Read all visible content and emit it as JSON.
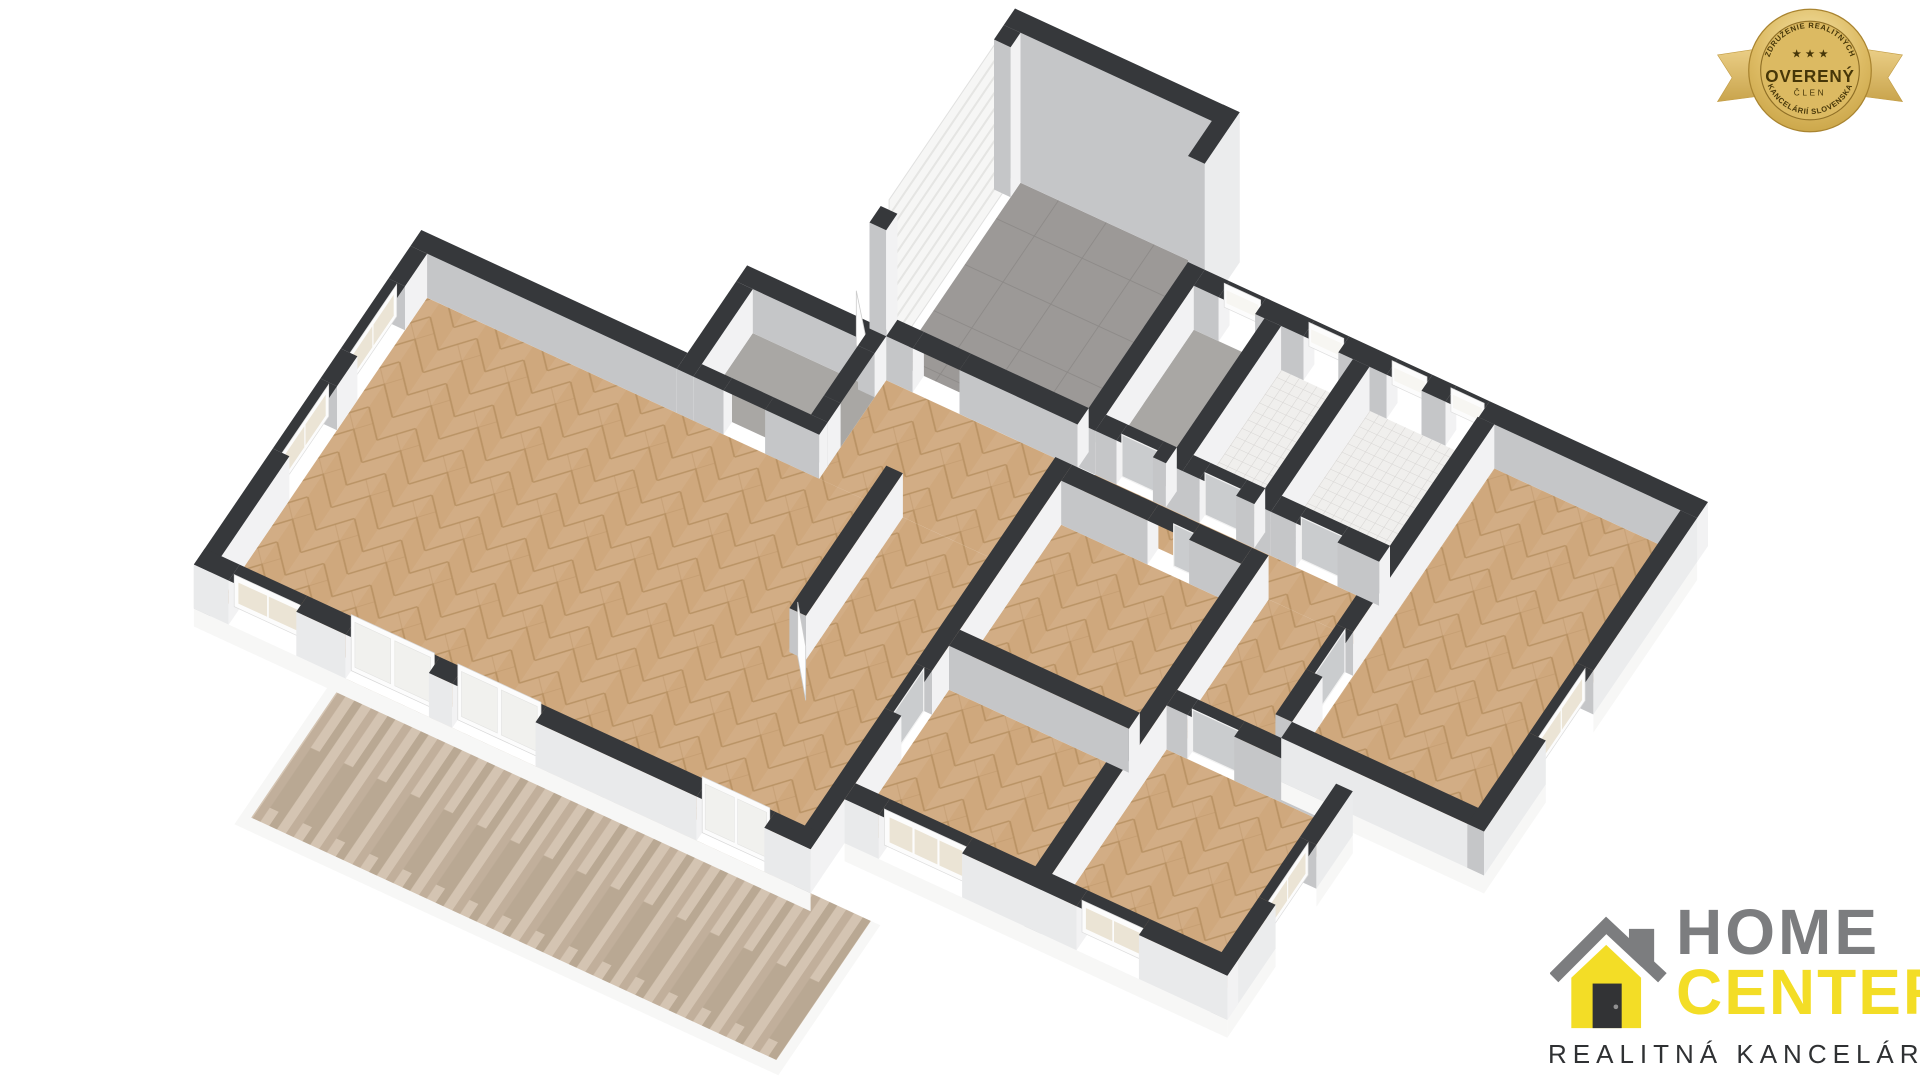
{
  "badge": {
    "top_text": "ZDRUŽENIE REALITNÝCH",
    "bottom_text": "KANCELÁRIÍ SLOVENSKA",
    "stars": "★ ★ ★",
    "center_text": "OVERENÝ",
    "sub_text": "ČLEN",
    "colors": {
      "ribbon": "#e3c06b",
      "ribbon_shadow": "#c19b43",
      "rim_light": "#f3e1a2",
      "rim_base": "#d4ad52",
      "center_fill": "#dcba62",
      "ring_line": "#8f6f26",
      "text": "#463608"
    }
  },
  "logo": {
    "line1": "HOME",
    "line2": "CENTER",
    "tagline": "REALITNÁ KANCELÁRIA",
    "colors": {
      "gray": "#7c7d7f",
      "yellow": "#f3dd26",
      "dark": "#2f3133",
      "door": "#323335",
      "knob": "#909091"
    }
  },
  "floorplan": {
    "type": "3d-floor-plan",
    "rooms": [
      {
        "name": "garage",
        "floor": "gray-tile"
      },
      {
        "name": "entry-hall",
        "floor": "herringbone-wood"
      },
      {
        "name": "pantry",
        "floor": "gray-screed"
      },
      {
        "name": "living-room",
        "floor": "herringbone-wood"
      },
      {
        "name": "corridor",
        "floor": "herringbone-wood"
      },
      {
        "name": "hallway",
        "floor": "herringbone-wood"
      },
      {
        "name": "technical-room",
        "floor": "gray-screed"
      },
      {
        "name": "wc",
        "floor": "white-mosaic-tile"
      },
      {
        "name": "bathroom",
        "floor": "white-mosaic-tile"
      },
      {
        "name": "bedroom-1",
        "floor": "herringbone-wood"
      },
      {
        "name": "bedroom-2",
        "floor": "herringbone-wood"
      },
      {
        "name": "bedroom-3",
        "floor": "herringbone-wood"
      },
      {
        "name": "bedroom-4",
        "floor": "herringbone-wood"
      },
      {
        "name": "terrace",
        "floor": "wood-deck"
      }
    ],
    "colors": {
      "wallTop": "#36383b",
      "faceShade": "#c5c6c8",
      "faceLight": "#f2f2f3",
      "extSouth": "#e9eaeb",
      "extEast": "#ebeced",
      "slab": "#f7f7f6",
      "woodBase": "#cfa87d",
      "woodLine": "#b68f61",
      "tileBase": "#9c9997",
      "tileLine": "#8c8987",
      "screed": "#a9a7a4",
      "mosaicBase": "#f0efed",
      "mosaicLine": "#d7d5d3",
      "deckBase": "#c9b7a4",
      "deckDark": "#b9a893",
      "deckMid": "#c1af9b",
      "deckLight": "#d4c4b2",
      "glassCream": "#ebe4d5",
      "glassPale": "#f1f1ee",
      "frame": "#fcfcfc",
      "doorPanel": "#caccce",
      "doorLeaf": "#fdfdfd"
    }
  }
}
